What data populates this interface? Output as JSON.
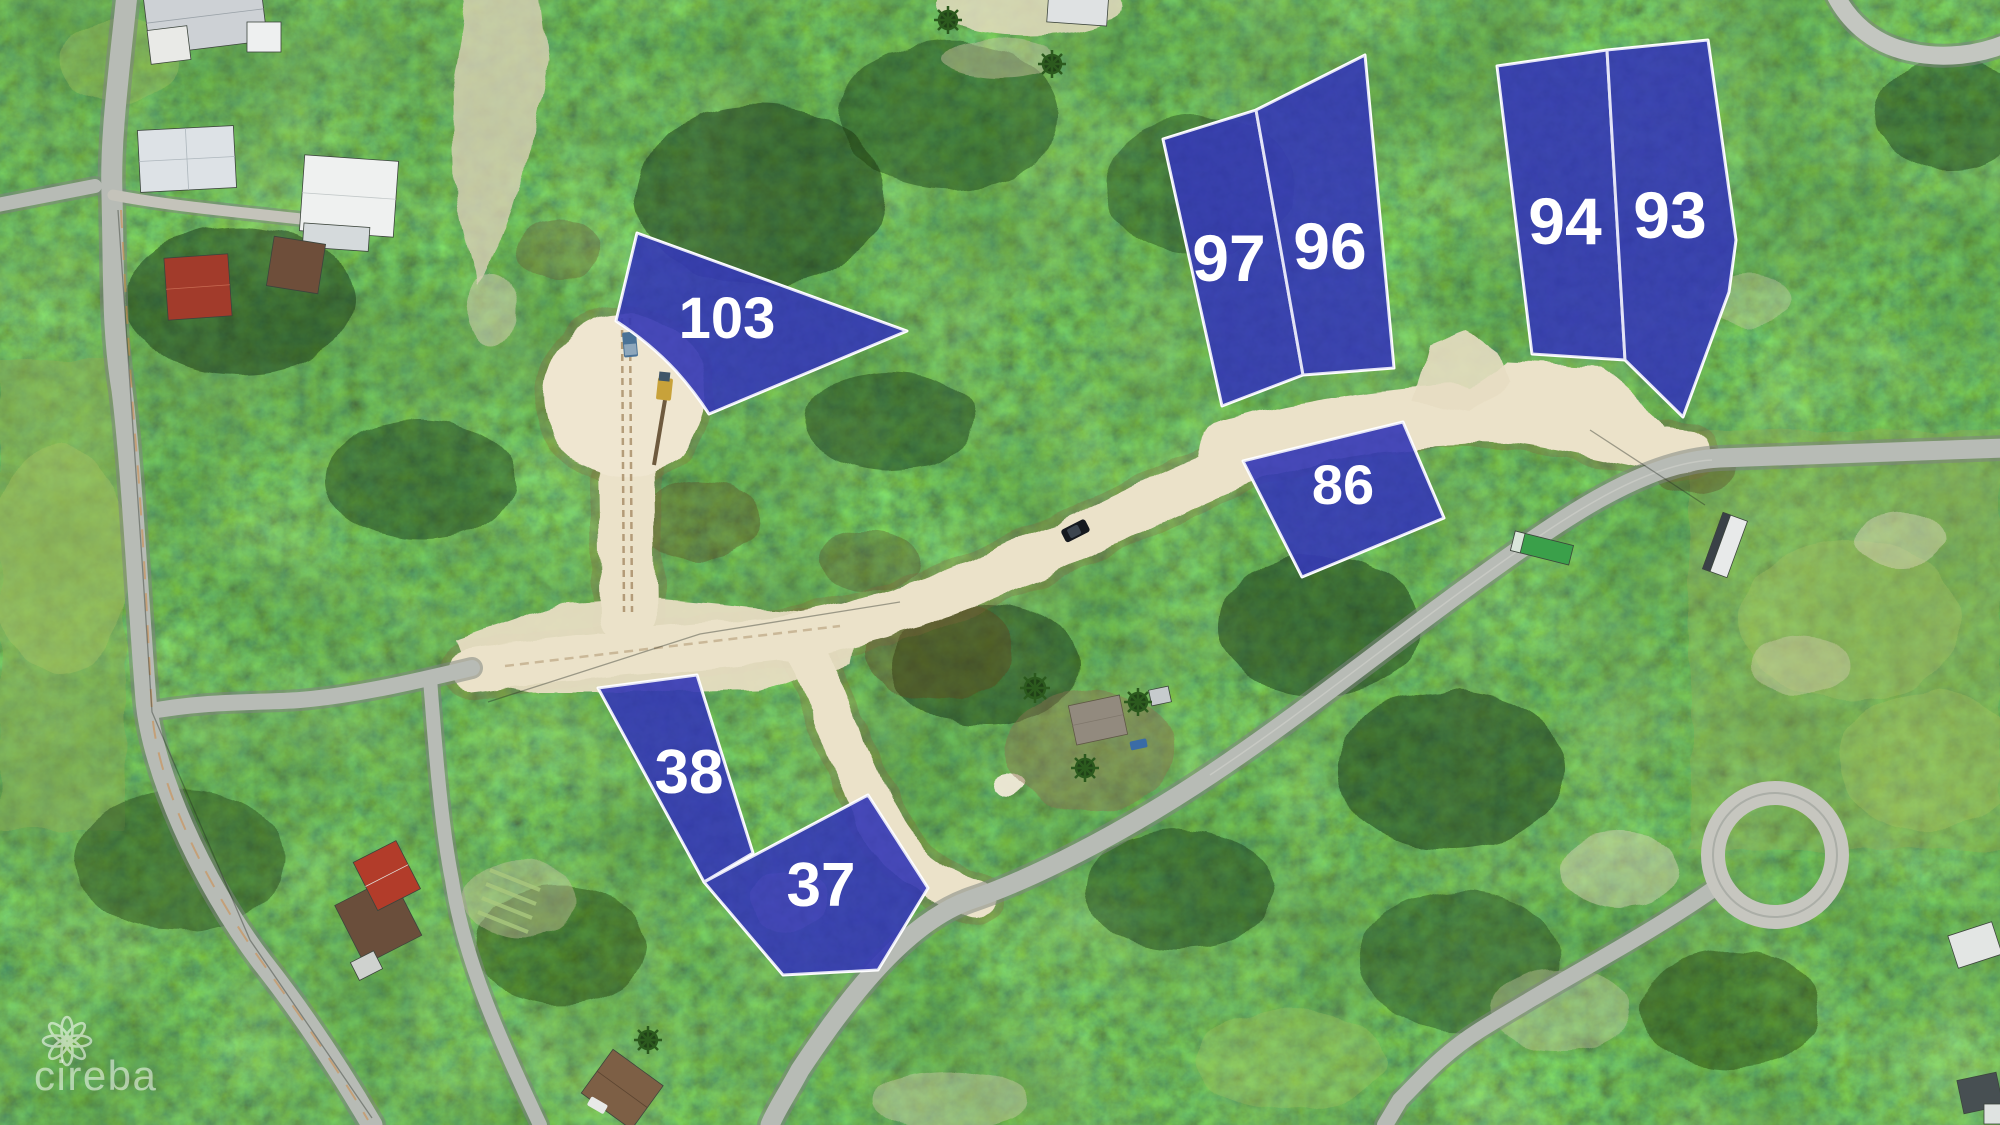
{
  "scene": {
    "description": "Aerial drone photograph of a subdivision with highlighted lots for sale",
    "vegetation_base": "#3f6b27",
    "sand_road_color": "#ebe2c9",
    "paved_road_color": "#b7bbb5"
  },
  "lots": [
    {
      "id": "103",
      "label": "103"
    },
    {
      "id": "97",
      "label": "97"
    },
    {
      "id": "96",
      "label": "96"
    },
    {
      "id": "94",
      "label": "94"
    },
    {
      "id": "93",
      "label": "93"
    },
    {
      "id": "86",
      "label": "86"
    },
    {
      "id": "38",
      "label": "38"
    },
    {
      "id": "37",
      "label": "37"
    }
  ],
  "lot_style": {
    "fill": "#2a2fae",
    "border": "#ffffff",
    "label_color": "#ffffff"
  },
  "watermark": {
    "text": "cireba",
    "icon": "flower-loop-icon",
    "color": "#ffffff"
  }
}
